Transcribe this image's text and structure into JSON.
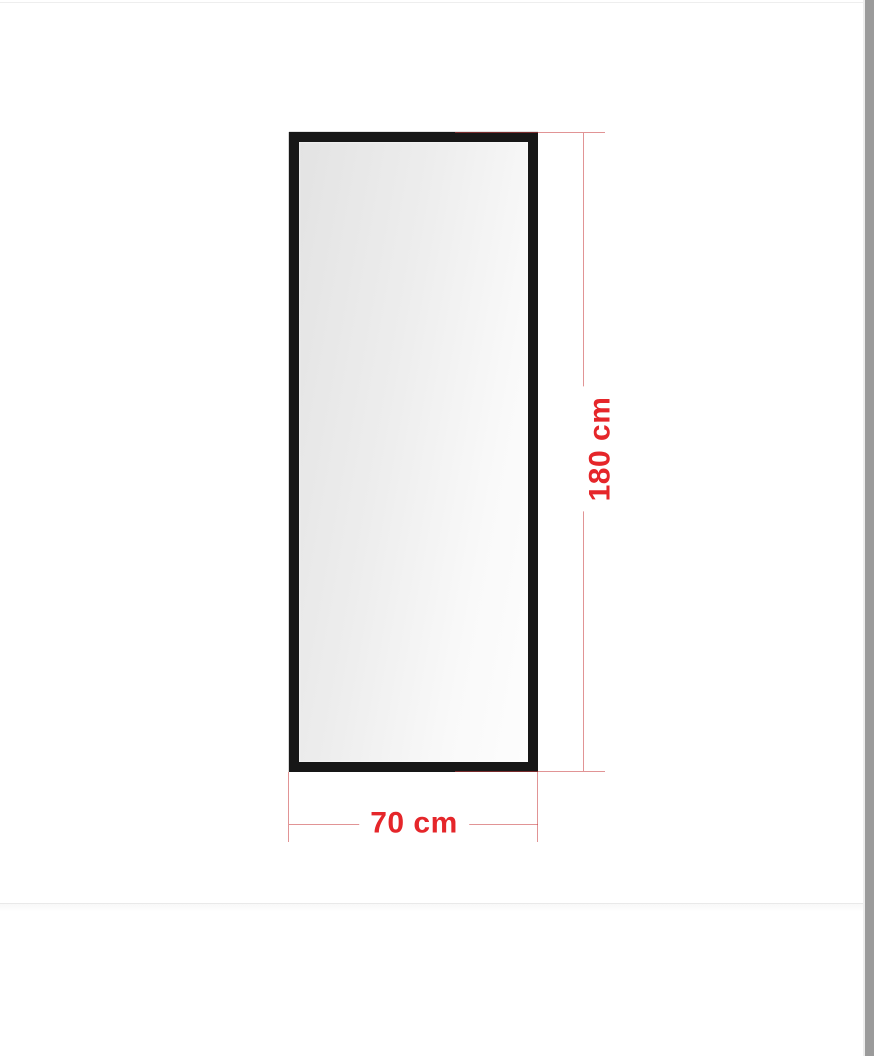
{
  "diagram": {
    "height_dimension": {
      "label": "180 cm"
    },
    "width_dimension": {
      "label": "70 cm"
    }
  },
  "colors": {
    "dimension_text_red": "#e5262a",
    "dimension_line_red": "#c83c3e",
    "frame_black": "#171717",
    "glass_gradient_start": "#e3e3e3",
    "glass_gradient_end": "#fdfdfd",
    "divider_gray": "#e9e9e9",
    "scrollbar_gray": "#9b9b9b"
  }
}
